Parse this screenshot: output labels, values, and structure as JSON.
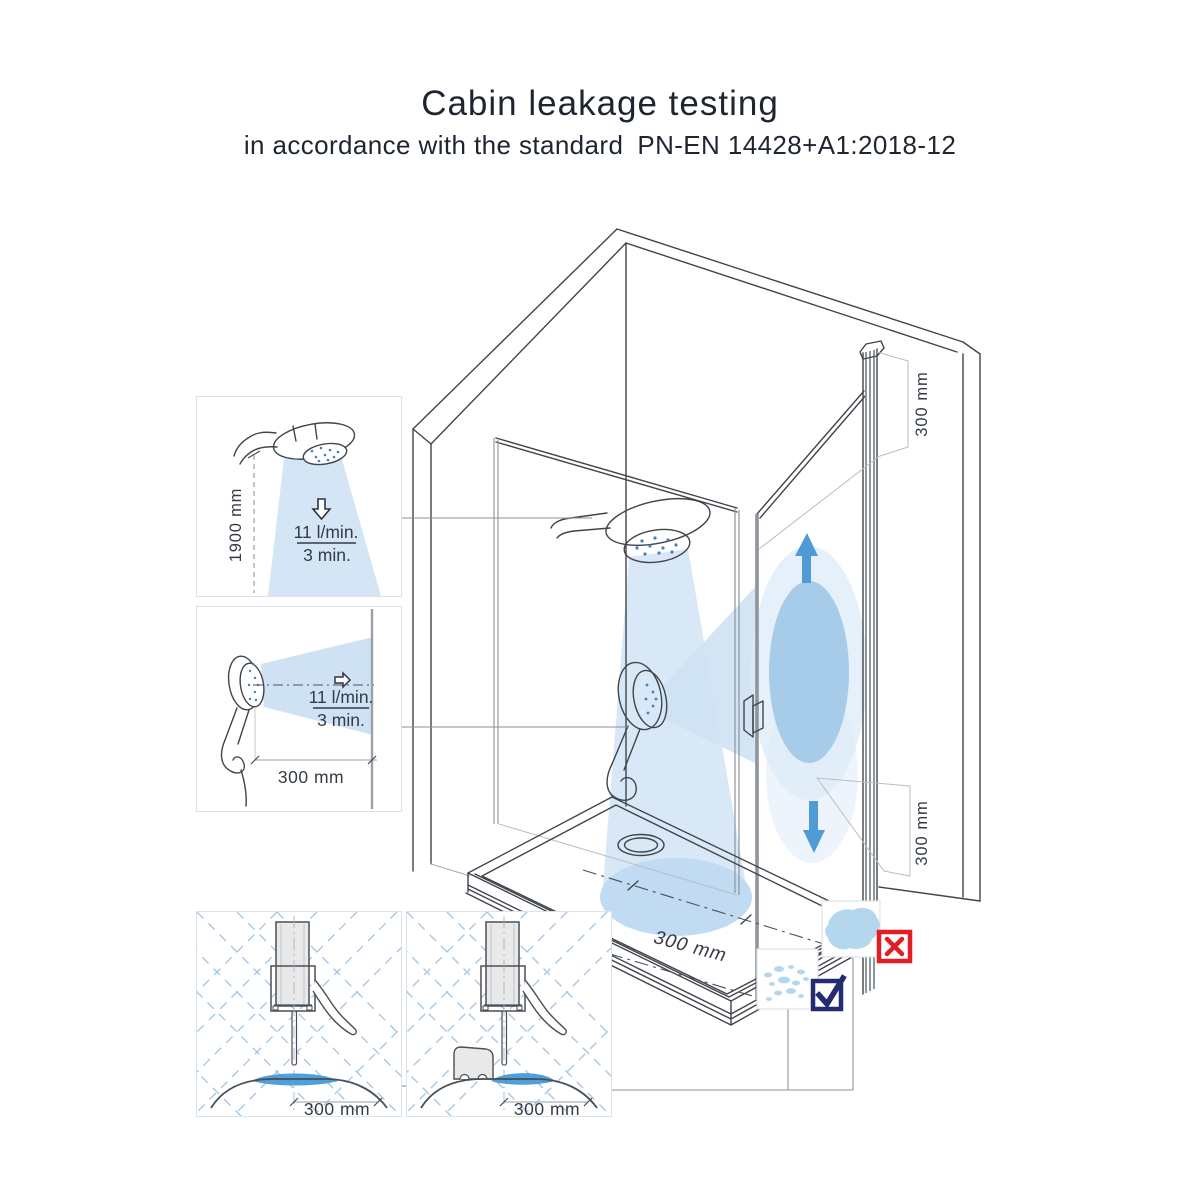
{
  "header": {
    "title": "Cabin leakage testing",
    "subtitle": "in accordance with the standard",
    "standard_code": "PN-EN 14428+A1:2018-12"
  },
  "insets": {
    "overhead_spray_test": {
      "height_dimension": "1900 mm",
      "flow_rate": "11 l/min.",
      "duration": "3 min."
    },
    "horizontal_spray_test": {
      "distance_dimension": "300 mm",
      "flow_rate": "11 l/min.",
      "duration": "3 min."
    },
    "bottom_seal_test": {
      "distance_dimension": "300 mm"
    },
    "bottom_seal_threshold_test": {
      "distance_dimension": "300 mm"
    }
  },
  "cabin": {
    "door_top_dimension": "300 mm",
    "door_bottom_dimension": "300 mm",
    "tray_dimension": "300 mm"
  },
  "results": {
    "fail_icon": "x-mark",
    "pass_icon": "checkmark"
  },
  "colors": {
    "spray_light": "#d4e6f6",
    "spray_mid": "#cfe2f4",
    "spray_oval": "#a6cce9",
    "spray_halo": "#dcebf8",
    "tray_splash": "#c0dbf2",
    "arrow_blue": "#4f9bd5",
    "water_blue": "#4f9fda",
    "droplet_blue": "#b5d7ee",
    "fail_red": "#e21d23",
    "pass_navy": "#242b70",
    "line_dark": "#40454c",
    "glass_gray": "#8e959c",
    "dim_gray": "#b8bec5",
    "text_dark": "#343b46",
    "title_dark": "#1d2530"
  }
}
